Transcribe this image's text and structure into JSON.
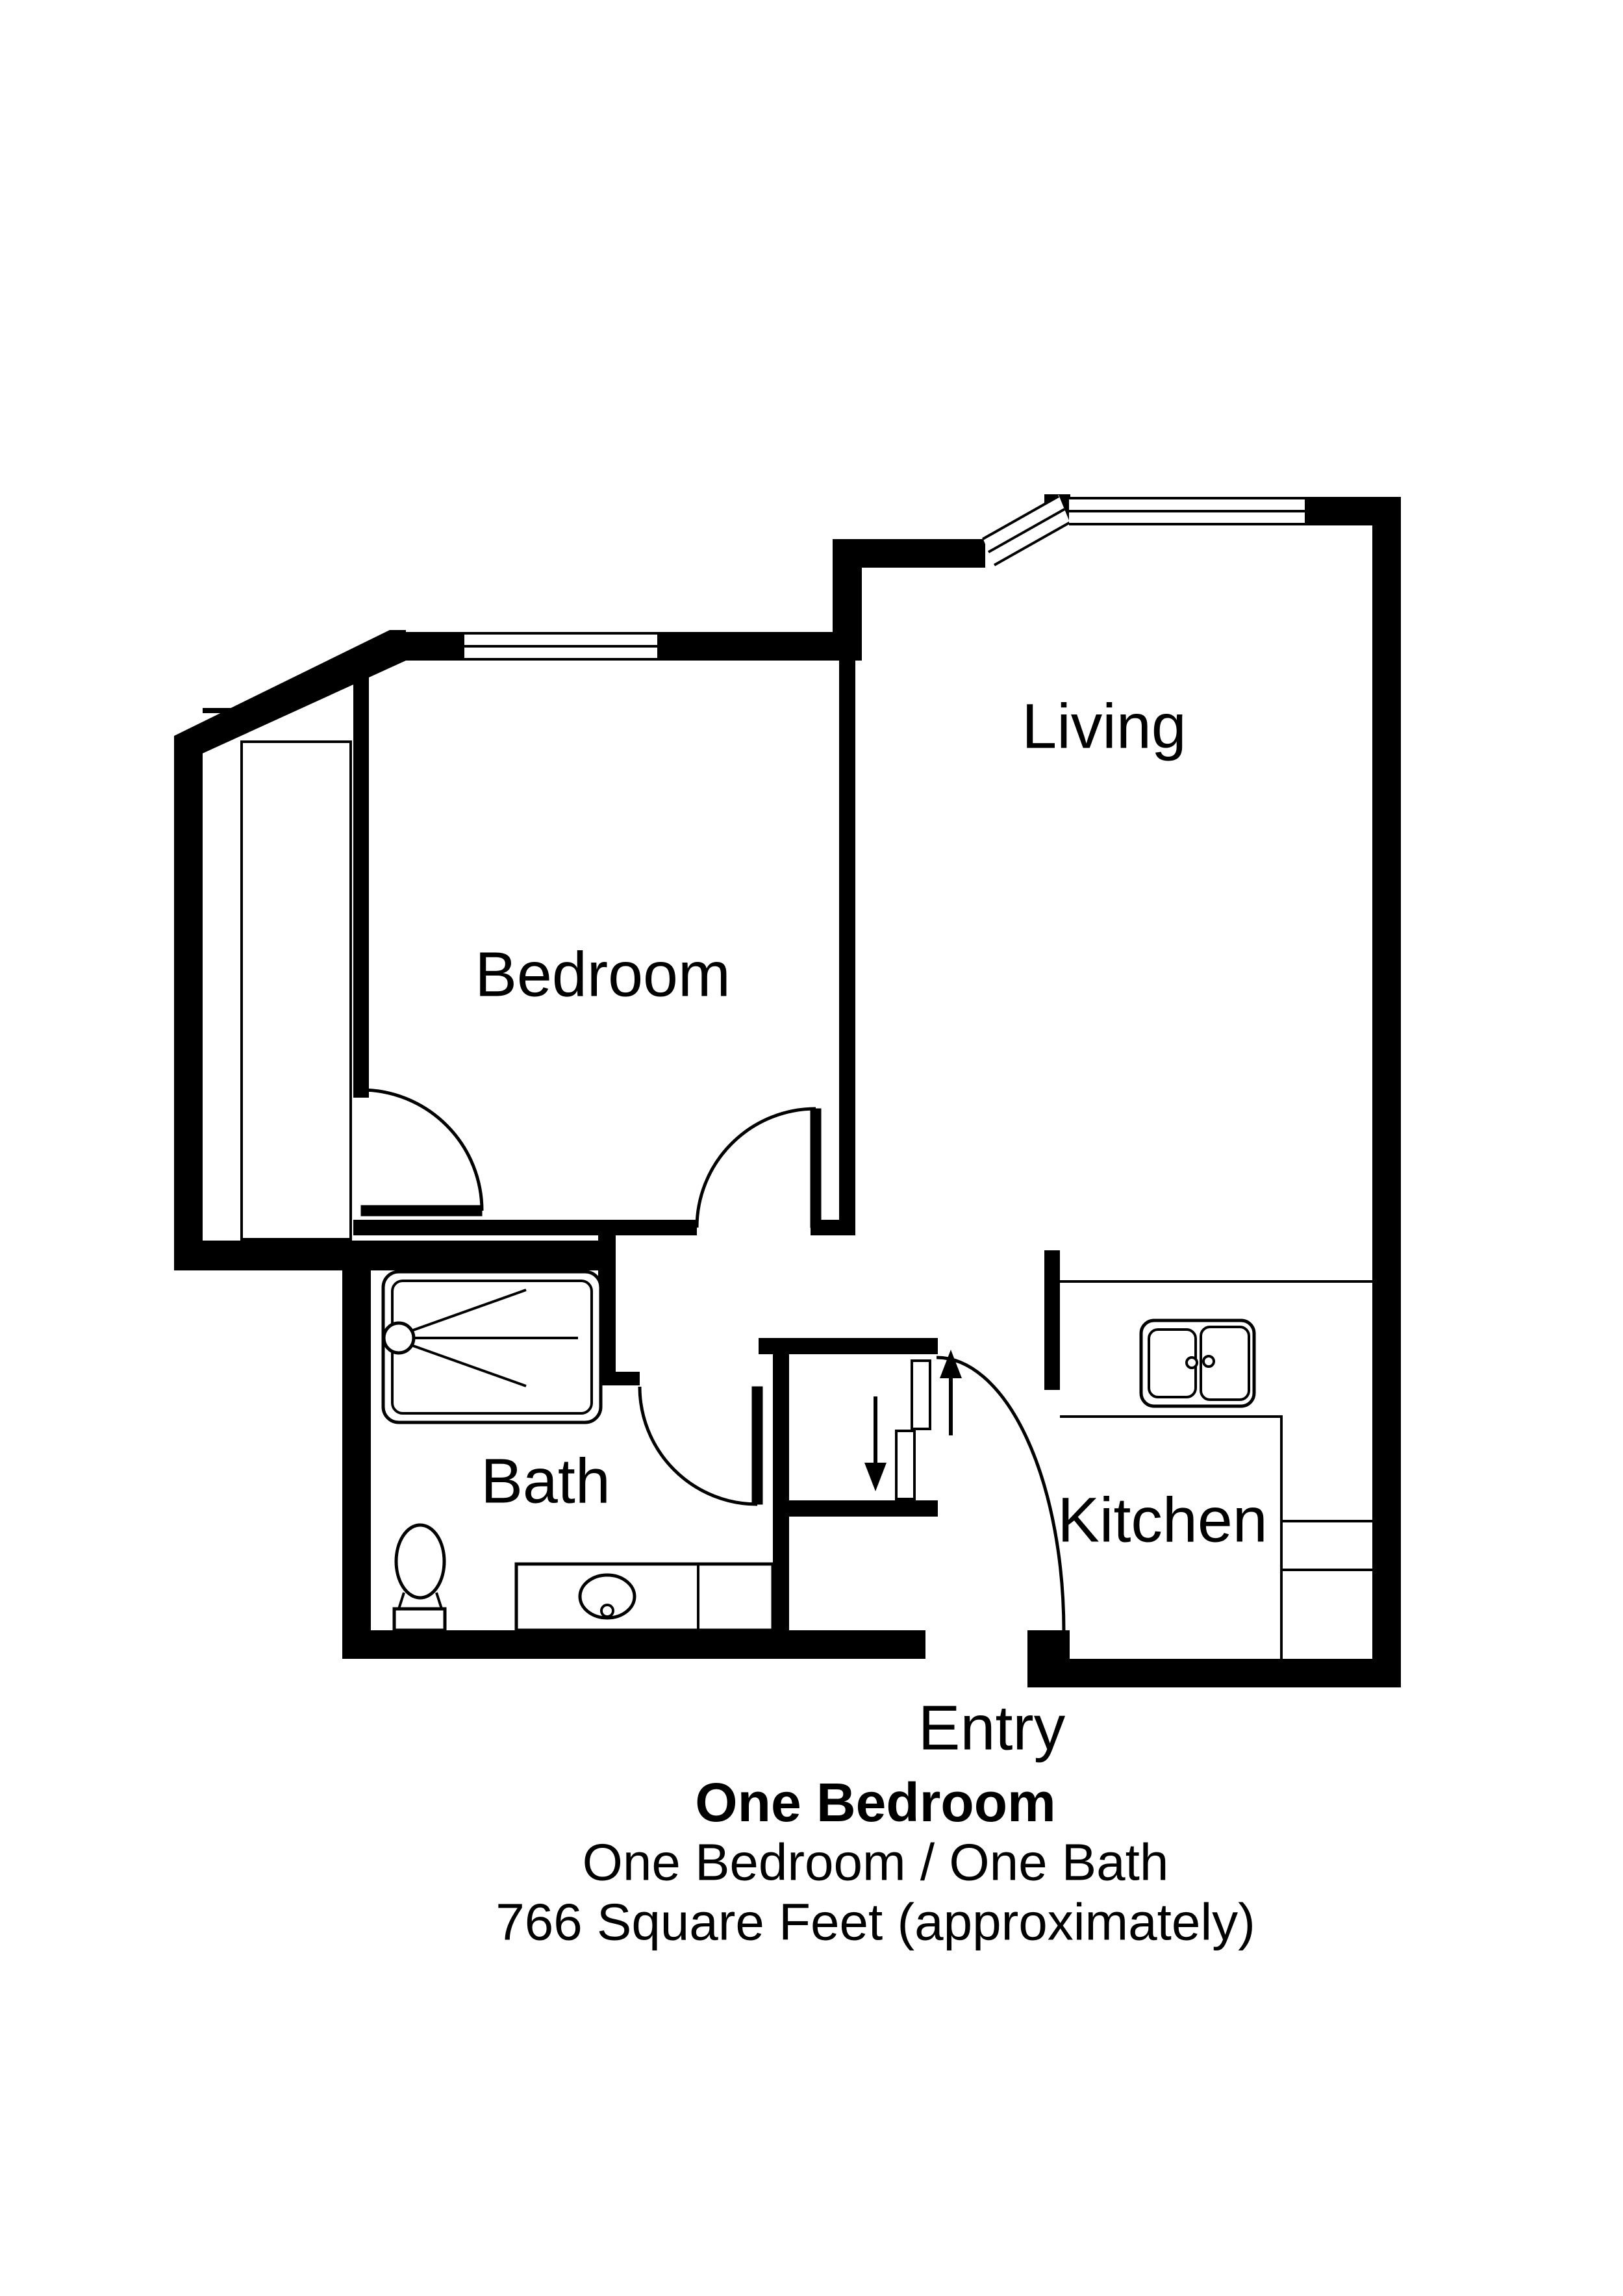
{
  "plan": {
    "background_color": "#ffffff",
    "wall_color": "#000000",
    "rooms": {
      "bedroom": {
        "label": "Bedroom"
      },
      "living": {
        "label": "Living"
      },
      "bath": {
        "label": "Bath"
      },
      "kitchen": {
        "label": "Kitchen"
      },
      "entry": {
        "label": "Entry"
      }
    },
    "fixtures": {
      "shower": "shower-with-head-icon",
      "toilet": "toilet-icon",
      "vanity": "vanity-sink-icon",
      "kitchen_sink": "double-basin-sink-icon",
      "bedroom_closet": "closet-with-swing-door-icon",
      "entry_closet": "sliding-bypass-doors-icon",
      "direction_arrows": "up-down-arrow-icons"
    },
    "windows": [
      "bedroom-window",
      "living-bay-diagonal-window",
      "living-top-window"
    ],
    "title": {
      "line1": "One Bedroom",
      "line2": "One Bedroom / One Bath",
      "line3": "766 Square Feet (approximately)"
    }
  }
}
